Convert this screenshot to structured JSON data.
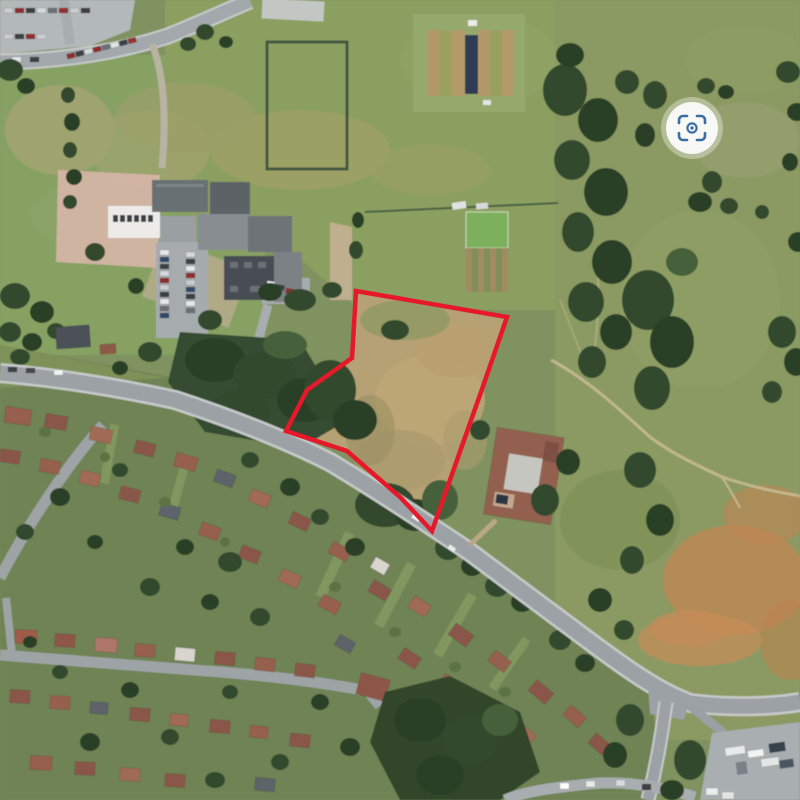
{
  "page": {
    "title": "Aerial site view with boundary overlay"
  },
  "overlay": {
    "boundary": {
      "label": "site-boundary",
      "color": "#e6192b",
      "stroke_width": 4.5,
      "points": "356,291 507,317 481,392 432,531 400,497 347,451 286,431 307,390 352,358"
    },
    "photosphere": {
      "label": "photosphere-360-control",
      "transform": "translate(692,128)",
      "halo_radius": 31,
      "disc_radius": 26,
      "glyph_color": "#3e6ea6",
      "disc_color": "#ffffff"
    }
  },
  "palette": {
    "field_green": "#87a164",
    "parkland_green": "#8a9a62",
    "dry_parcel_tan": "#b5a173",
    "woodland_dark": "#33492f",
    "road_gray": "#9ba1a5",
    "roof_terracotta": "#8a564a",
    "roof_gray": "#5d6468",
    "cricket_cover_navy": "#2f3e52",
    "playground_pink": "#d7b6a8",
    "scorched_field_orange": "#c48c58"
  }
}
